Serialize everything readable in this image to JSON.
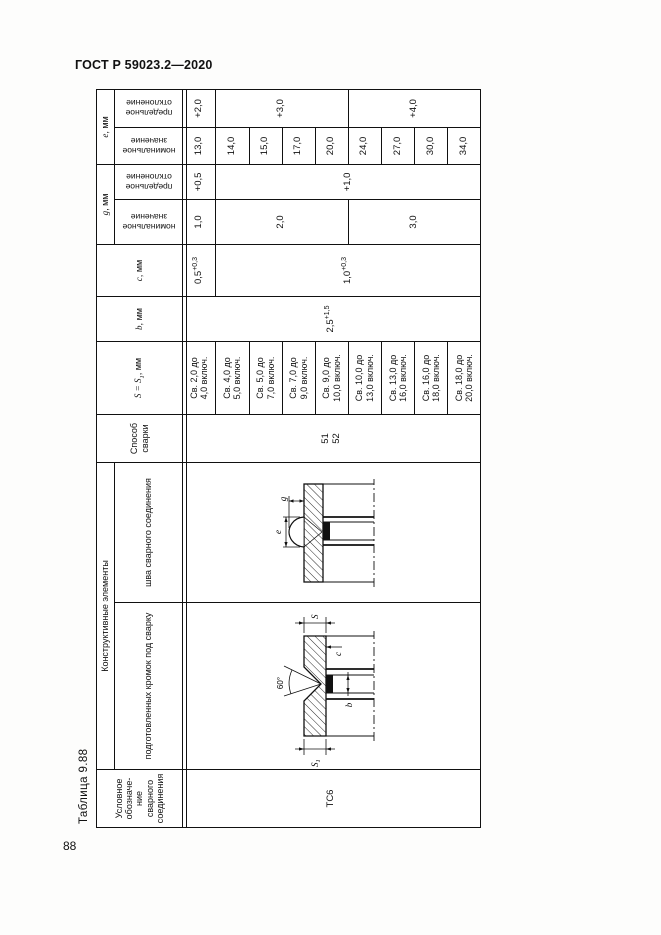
{
  "page": {
    "doc_header": "ГОСТ Р 59023.2—2020",
    "page_number": "88",
    "table_caption": "Таблица 9.88"
  },
  "table": {
    "headers": {
      "designation": "Условное\nобозначе-\nние\nсварного\nсоединения",
      "constructive": "Конструктивные элементы",
      "prep": "подготовленных кромок под сварку",
      "seam": "шва сварного соединения",
      "method": "Способ\nсварки",
      "s_prefix": "S = S",
      "s_sub": "1",
      "s_unit": ", мм",
      "b_sym": "b",
      "b_unit": ", мм",
      "c_sym": "c",
      "c_unit": ", мм",
      "g_sym": "g",
      "g_unit": ", мм",
      "e_sym": "e",
      "e_unit": ", мм",
      "nominal": "номинальное\nзначение",
      "limit": "предельное\nотклонение"
    },
    "merged": {
      "designation": "ТС6",
      "method": "51\n52",
      "b": {
        "base": "2,5",
        "sup": "+1,5"
      },
      "c1": {
        "base": "0,5",
        "sup": "+0,3"
      },
      "c2": {
        "base": "1,0",
        "sup": "+0,3"
      },
      "g_nom": [
        "1,0",
        "2,0",
        "3,0"
      ],
      "g_lim": [
        "+0,5",
        "+1,0"
      ],
      "e_lim": [
        "+2,0",
        "+3,0",
        "+4,0"
      ]
    },
    "rows": [
      {
        "s_range": "Св. 2,0 до\n4,0 включ.",
        "e_nom": "13,0"
      },
      {
        "s_range": "Св. 4,0 до\n5,0 включ.",
        "e_nom": "14,0"
      },
      {
        "s_range": "Св. 5,0 до\n7,0 включ.",
        "e_nom": "15,0"
      },
      {
        "s_range": "Св. 7,0 до\n9,0 включ.",
        "e_nom": "17,0"
      },
      {
        "s_range": "Св. 9,0 до\n10,0 включ.",
        "e_nom": "20,0"
      },
      {
        "s_range": "Св. 10,0 до\n13,0 включ.",
        "e_nom": "24,0"
      },
      {
        "s_range": "Св. 13,0 до\n16,0 включ.",
        "e_nom": "27,0"
      },
      {
        "s_range": "Св. 16,0 до\n18,0 включ.",
        "e_nom": "30,0"
      },
      {
        "s_range": "Св. 18,0 до\n20,0 включ.",
        "e_nom": "34,0"
      }
    ],
    "drawing_labels": {
      "s": "S",
      "s1_base": "S",
      "s1_sub": "1",
      "angle": "60°",
      "b": "b",
      "c": "c",
      "e": "e",
      "g": "g"
    }
  }
}
